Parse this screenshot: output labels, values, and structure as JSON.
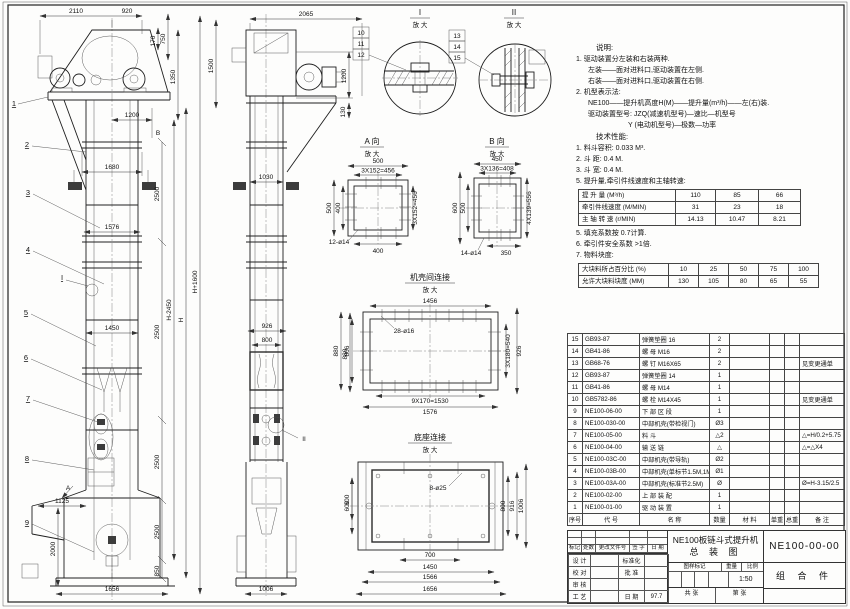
{
  "front_view": {
    "balloons": [
      "1",
      "2",
      "3",
      "4",
      "5",
      "6",
      "7",
      "8",
      "9"
    ],
    "marks": {
      "a": "A",
      "b": "B",
      "i": "I"
    },
    "dims": {
      "w2110": "2110",
      "w920": "920",
      "h170": "170",
      "h750": "750",
      "h1350": "1350",
      "h1500": "1500",
      "w1200": "1200",
      "w1680": "1680",
      "w1576": "1576",
      "w1450": "1450",
      "w1125": "1125",
      "v2500_1": "2500",
      "v2500_2": "2500",
      "v2500_3": "2500",
      "v2500_4": "2500",
      "v2000": "2000",
      "v850": "850",
      "w1656": "1656",
      "hm": "H-2450",
      "hh": "H",
      "hp": "H+1600"
    }
  },
  "side_view": {
    "marks": {
      "ii": "II"
    },
    "dims": {
      "w2065": "2065",
      "v1200": "1200",
      "v130": "130",
      "w1030": "1030",
      "w926": "926",
      "w800": "800",
      "v880": "880",
      "v600": "600",
      "w1006": "1006"
    }
  },
  "detail_i": {
    "label": "I",
    "zoom_label": "放 大",
    "balloons": [
      "10",
      "11",
      "12"
    ]
  },
  "detail_ii": {
    "label": "II",
    "zoom_label": "放 大",
    "balloons": [
      "13",
      "14",
      "15"
    ]
  },
  "view_a": {
    "label": "A 向",
    "zoom_label": "放 大",
    "dims": {
      "top": "500",
      "pitch_top": "3X152=456",
      "left": "500",
      "left2": "400",
      "pitch_right": "3X152=456",
      "bottom": "400",
      "holes": "12-ø14"
    }
  },
  "view_b": {
    "label": "B 向",
    "zoom_label": "放 大",
    "dims": {
      "top": "450",
      "pitch_top": "3X136=408",
      "left": "600",
      "left2": "500",
      "pitch_right": "4X139=556",
      "bottom": "350",
      "holes": "14-ø14"
    }
  },
  "casing_joint": {
    "label": "机壳间连接",
    "zoom_label": "放 大",
    "dims": {
      "top": "1456",
      "holes": "28-ø16",
      "left": "880",
      "left2": "806",
      "pitch_right": "3X180=540",
      "right": "926",
      "pitch_bottom": "9X170=1530",
      "bottom": "1576"
    }
  },
  "base_joint": {
    "label": "底座连接",
    "zoom_label": "放 大",
    "dims": {
      "holes": "8-ø25",
      "left": "600",
      "right1": "800",
      "right2": "916",
      "right3": "1006",
      "b700": "700",
      "b1450": "1450",
      "b1566": "1566",
      "b1656": "1656"
    }
  },
  "notes": {
    "heading": "说明:",
    "lines": [
      "1. 驱动装置分左装和右装两种.",
      "左装——面对进料口,驱动装置在左侧.",
      "右装——面对进料口,驱动装置在右侧.",
      "2. 机型表示法:",
      "NE100——提升机高度H(M)——提升量(m³/h)——左(右)装.",
      "驱动装置型号: JZQ(减速机型号)—速比—机型号",
      "Y (电动机型号)—极数—功率"
    ]
  },
  "tech": {
    "heading": "技术性能:",
    "items": [
      "1. 料斗容积: 0.033 M³.",
      "2. 斗    距: 0.4 M.",
      "3. 斗    宽: 0.4 M.",
      "5. 提升量,牵引件线速度和主轴转速:"
    ],
    "items2": [
      "5. 填充系数按 0.7计算.",
      "6. 牵引件安全系数 >1倍.",
      "7. 物料块度:"
    ]
  },
  "speed_table": {
    "rows": [
      {
        "label": "提 升 量  (M³/h)",
        "v1": "110",
        "v2": "85",
        "v3": "66"
      },
      {
        "label": "牵引件线速度 (M/MIN)",
        "v1": "31",
        "v2": "23",
        "v3": "18"
      },
      {
        "label": "主 轴 转 速 (r/MIN)",
        "v1": "14.13",
        "v2": "10.47",
        "v3": "8.21"
      }
    ]
  },
  "lump_table": {
    "rows": [
      {
        "label": "大块料所占百分比 (%)",
        "v1": "10",
        "v2": "25",
        "v3": "50",
        "v4": "75",
        "v5": "100"
      },
      {
        "label": "允许大块料块度 (MM)",
        "v1": "130",
        "v2": "105",
        "v3": "80",
        "v4": "65",
        "v5": "55"
      }
    ]
  },
  "parts_list": {
    "headers": {
      "no": "序号",
      "code": "代  号",
      "name": "名  称",
      "qty": "数量",
      "material": "材  料",
      "unit_weight": "单重",
      "total_weight": "总重",
      "remark": "备 注"
    },
    "rows": [
      {
        "no": "15",
        "code": "GB93-87",
        "name": "弹簧垫圈 16",
        "qty": "2",
        "material": "",
        "unit_weight": "",
        "total_weight": "",
        "remark": ""
      },
      {
        "no": "14",
        "code": "GB41-86",
        "name": "螺 母 M16",
        "qty": "2",
        "material": "",
        "unit_weight": "",
        "total_weight": "",
        "remark": ""
      },
      {
        "no": "13",
        "code": "GB68-76",
        "name": "螺 钉 M16X65",
        "qty": "2",
        "material": "",
        "unit_weight": "",
        "total_weight": "",
        "remark": "见变更通单"
      },
      {
        "no": "12",
        "code": "GB93-87",
        "name": "弹簧垫圈 14",
        "qty": "1",
        "material": "",
        "unit_weight": "",
        "total_weight": "",
        "remark": ""
      },
      {
        "no": "11",
        "code": "GB41-86",
        "name": "螺 母 M14",
        "qty": "1",
        "material": "",
        "unit_weight": "",
        "total_weight": "",
        "remark": ""
      },
      {
        "no": "10",
        "code": "GB5782-86",
        "name": "螺 栓 M14X45",
        "qty": "1",
        "material": "",
        "unit_weight": "",
        "total_weight": "",
        "remark": "见变更通单"
      },
      {
        "no": "9",
        "code": "NE100-06-00",
        "name": "下 部 区 段",
        "qty": "1",
        "material": "",
        "unit_weight": "",
        "total_weight": "",
        "remark": ""
      },
      {
        "no": "8",
        "code": "NE100-030-00",
        "name": "中部机壳(带检视门)",
        "qty": "Ø3",
        "material": "",
        "unit_weight": "",
        "total_weight": "",
        "remark": ""
      },
      {
        "no": "7",
        "code": "NE100-05-00",
        "name": "料  斗",
        "qty": "△2",
        "material": "",
        "unit_weight": "",
        "total_weight": "",
        "remark": "△=H/0.2+5.75"
      },
      {
        "no": "6",
        "code": "NE100-04-00",
        "name": "输 送 链",
        "qty": "△",
        "material": "",
        "unit_weight": "",
        "total_weight": "",
        "remark": "△=△X4"
      },
      {
        "no": "5",
        "code": "NE100-03C-00",
        "name": "中部机壳(带导轨)",
        "qty": "Ø2",
        "material": "",
        "unit_weight": "",
        "total_weight": "",
        "remark": ""
      },
      {
        "no": "4",
        "code": "NE100-03B-00",
        "name": "中部机壳(单标节1.5M,1M)",
        "qty": "Ø1",
        "material": "",
        "unit_weight": "",
        "total_weight": "",
        "remark": ""
      },
      {
        "no": "3",
        "code": "NE100-03A-00",
        "name": "中部机壳(标准节2.5M)",
        "qty": "Ø",
        "material": "",
        "unit_weight": "",
        "total_weight": "",
        "remark": "Ø=H-3.15/2.5"
      },
      {
        "no": "2",
        "code": "NE100-02-00",
        "name": "上 部 装 配",
        "qty": "1",
        "material": "",
        "unit_weight": "",
        "total_weight": "",
        "remark": ""
      },
      {
        "no": "1",
        "code": "NE100-01-00",
        "name": "驱 动 装 置",
        "qty": "1",
        "material": "",
        "unit_weight": "",
        "total_weight": "",
        "remark": ""
      }
    ]
  },
  "title_block": {
    "rev_headers": [
      "标记",
      "处数",
      "更改文件号",
      "签 字",
      "日 期"
    ],
    "left_rows": [
      {
        "c1": "设 计",
        "c2": "",
        "c3": "标准化",
        "c4": ""
      },
      {
        "c1": "校 对",
        "c2": "",
        "c3": "批 准",
        "c4": ""
      },
      {
        "c1": "审 核",
        "c2": "",
        "c3": "",
        "c4": ""
      },
      {
        "c1": "工 艺",
        "c2": "",
        "c3": "日 期",
        "c4": "97.7"
      }
    ],
    "title_line1": "NE100板链斗式提升机",
    "title_line2": "总 装 图",
    "drawing_no": "NE100-00-00",
    "part_type": "组 合 件",
    "stamp_label": "图样标记",
    "weight_label": "重量",
    "scale_label": "比例",
    "scale": "1:50",
    "sheet_label1": "共  张",
    "sheet_label2": "第  张"
  }
}
